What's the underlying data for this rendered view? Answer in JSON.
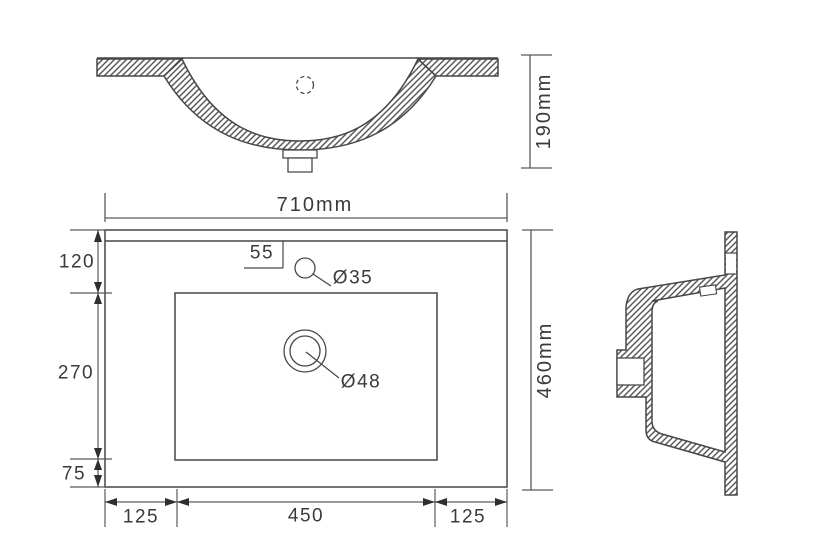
{
  "drawing": {
    "front_view": {
      "height_dim": "190mm"
    },
    "plan_view": {
      "width_dim": "710mm",
      "depth_dim": "460mm",
      "faucet_offset_dim": "55",
      "faucet_hole_dia": "Ø35",
      "drain_hole_dia": "Ø48",
      "left_dims": {
        "top": "120",
        "middle": "270",
        "bottom": "75"
      },
      "bottom_dims": {
        "left": "125",
        "center": "450",
        "right": "125"
      }
    }
  },
  "colors": {
    "line": "#474747",
    "dimension": "#5a5a5a",
    "text": "#3a3a3a",
    "background": "#ffffff"
  }
}
